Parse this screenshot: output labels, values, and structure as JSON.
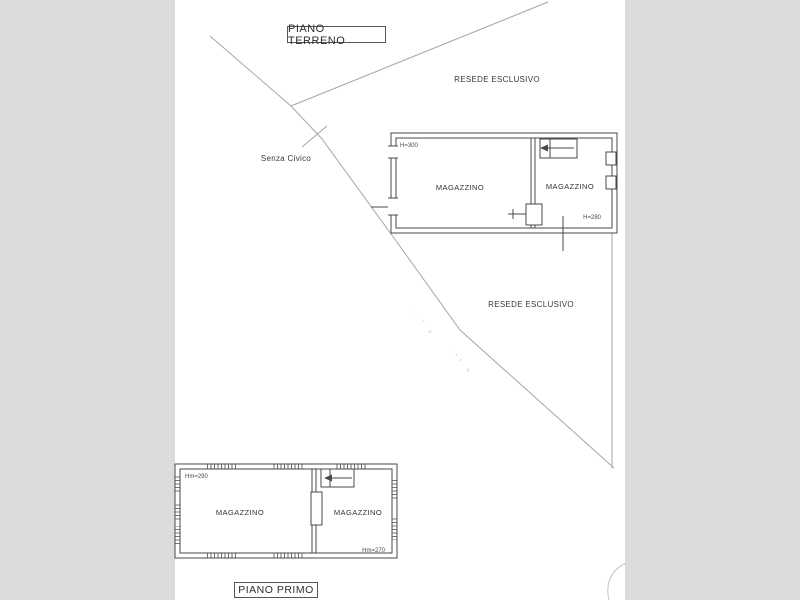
{
  "palette": {
    "bg": "#dcdcdc",
    "paper": "#ffffff",
    "ink": "#4a4a4a",
    "boundary": "#a6a6a6",
    "faint": "#c4c4c4",
    "text": "#333333"
  },
  "floor_labels": {
    "ground": "PIANO TERRENO",
    "first": "PIANO PRIMO"
  },
  "site": {
    "street_label": "Senza Civico",
    "yard_label_top": "RESEDE ESCLUSIVO",
    "yard_label_mid": "RESEDE ESCLUSIVO",
    "survey_marks_a": "· ·· · t · b",
    "survey_marks_b": "· · + t · b"
  },
  "ground_floor": {
    "rooms": [
      {
        "label": "MAGAZZINO",
        "height_note": "H=300"
      },
      {
        "label": "MAGAZZINO",
        "height_note": "H=280"
      }
    ]
  },
  "first_floor": {
    "rooms": [
      {
        "label": "MAGAZZINO",
        "height_note": "Hm=290"
      },
      {
        "label": "MAGAZZINO",
        "height_note": "Hm=270"
      }
    ]
  }
}
